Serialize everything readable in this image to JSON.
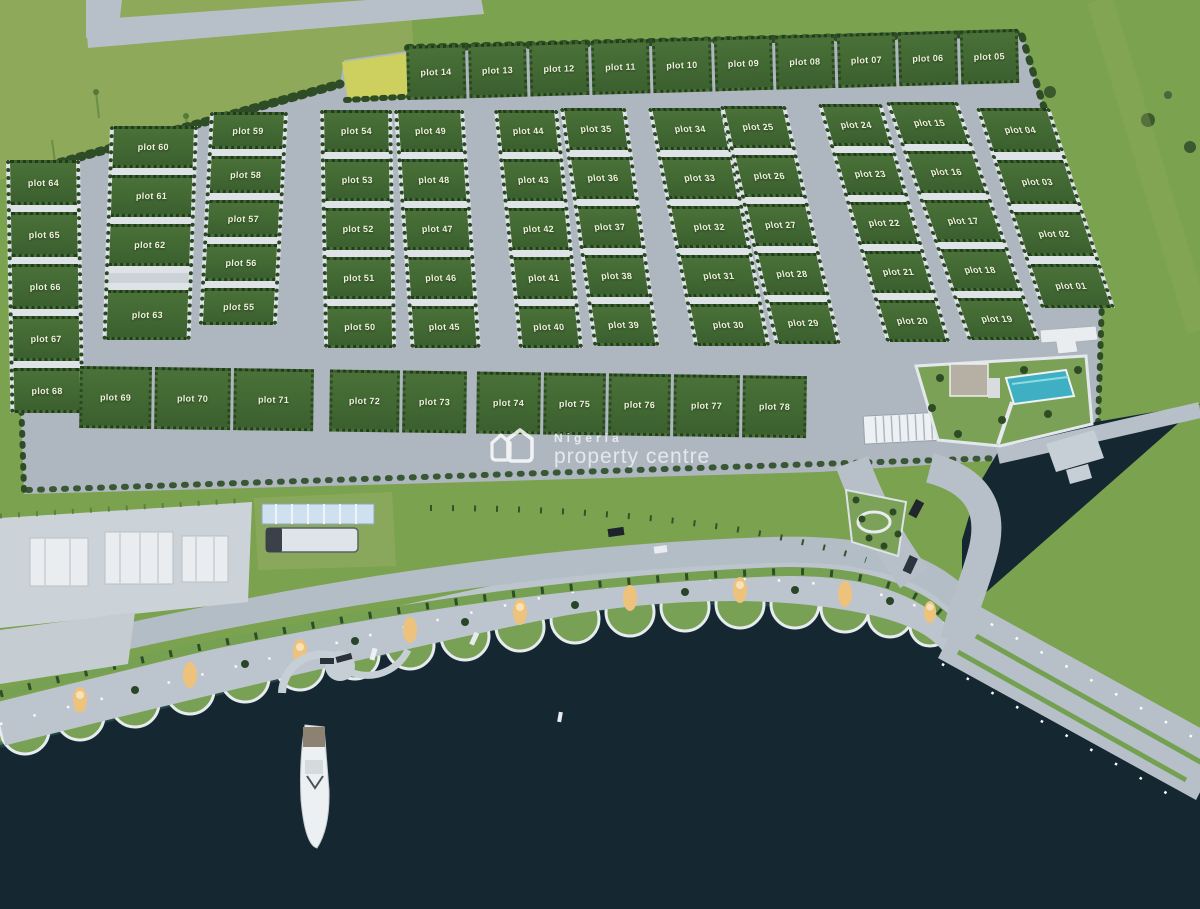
{
  "watermark": {
    "line1": "Nigeria",
    "line2": "property centre"
  },
  "plots": {
    "top_row": [
      "plot 14",
      "plot 13",
      "plot 12",
      "plot 11",
      "plot 10",
      "plot 09",
      "plot 08",
      "plot 07",
      "plot 06",
      "plot 05"
    ],
    "col_01s": [
      "plot 04",
      "plot 03",
      "plot 02",
      "plot 01"
    ],
    "col_15s": [
      "plot 15",
      "plot 16",
      "plot 17",
      "plot 18",
      "plot 19"
    ],
    "col_20s": [
      "plot 24",
      "plot 23",
      "plot 22",
      "plot 21",
      "plot 20"
    ],
    "col_25s": [
      "plot 25",
      "plot 26",
      "plot 27",
      "plot 28",
      "plot 29"
    ],
    "col_30s": [
      "plot 34",
      "plot 33",
      "plot 32",
      "plot 31",
      "plot 30"
    ],
    "col_35s": [
      "plot 35",
      "plot 36",
      "plot 37",
      "plot 38",
      "plot 39"
    ],
    "col_40s": [
      "plot 44",
      "plot 43",
      "plot 42",
      "plot 41",
      "plot 40"
    ],
    "col_45s": [
      "plot 49",
      "plot 48",
      "plot 47",
      "plot 46",
      "plot 45"
    ],
    "col_50s": [
      "plot 54",
      "plot 53",
      "plot 52",
      "plot 51",
      "plot 50"
    ],
    "col_55s": [
      "plot 59",
      "plot 58",
      "plot 57",
      "plot 56",
      "plot 55"
    ],
    "col_60s": [
      "plot 60",
      "plot 61",
      "plot 62",
      "plot 63"
    ],
    "col_64s": [
      "plot 64",
      "plot 65",
      "plot 66",
      "plot 67",
      "plot 68"
    ],
    "bottom_row": [
      "plot 69",
      "plot 70",
      "plot 71",
      "plot 72",
      "plot 73",
      "plot 74",
      "plot 75",
      "plot 76",
      "plot 77",
      "plot 78"
    ]
  },
  "colors": {
    "field_green": "#7ba24f",
    "plot_green": "#3f6533",
    "road_grey": "#b0bac3",
    "driveway_white": "#dde3e7",
    "water_navy": "#152731",
    "pool_teal": "#3fb0c4",
    "glow_tree_orange": "#edc27d",
    "watermark_white": "#ffffff"
  }
}
